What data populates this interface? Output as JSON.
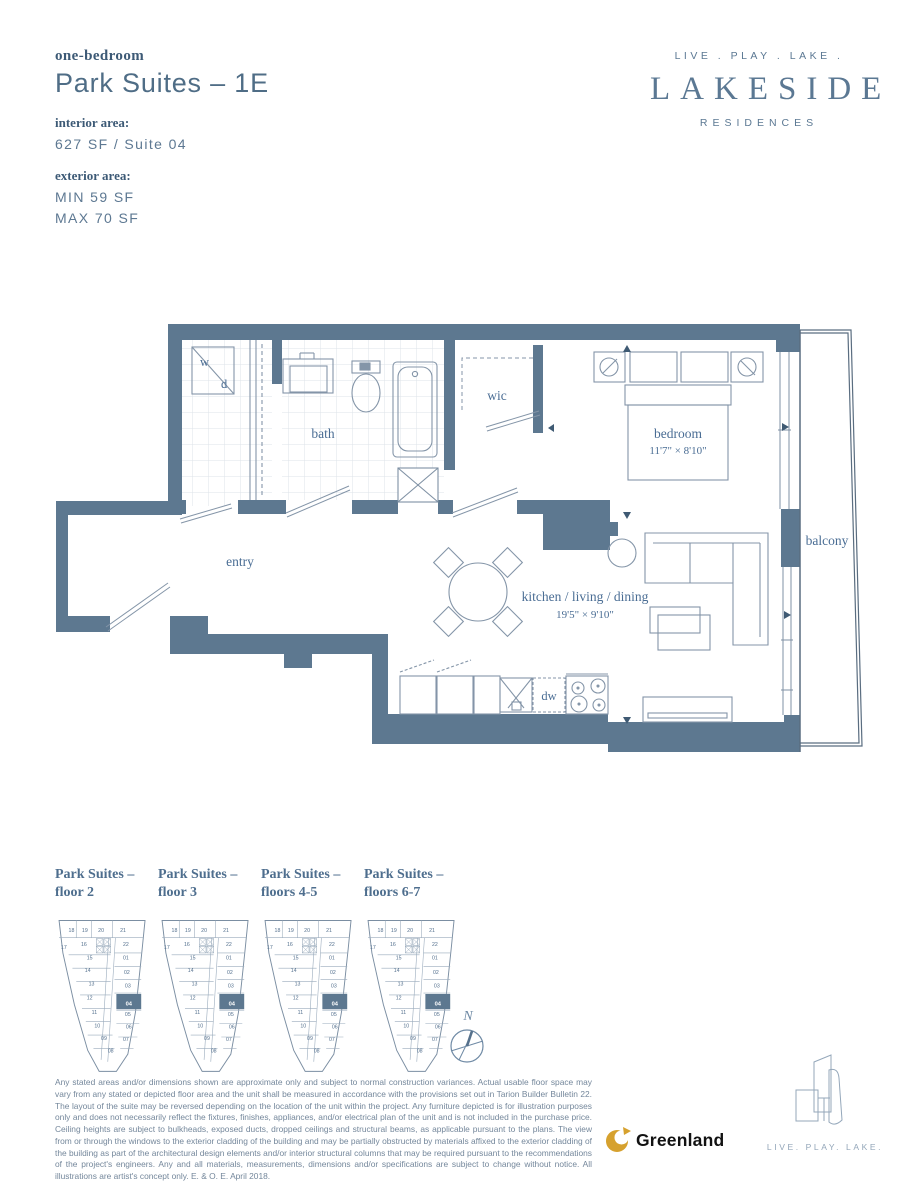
{
  "header": {
    "unit_type": "one-bedroom",
    "title": "Park Suites – 1E",
    "interior_label": "interior area:",
    "interior_value": "627 SF / Suite 04",
    "exterior_label": "exterior area:",
    "exterior_min": "MIN 59 SF",
    "exterior_max": "MAX 70 SF"
  },
  "brand": {
    "tagline": "LIVE . PLAY . LAKE .",
    "name": "LAKESIDE",
    "subname": "RESIDENCES"
  },
  "floorplan": {
    "labels": {
      "washer": "w",
      "dryer": "d",
      "bath": "bath",
      "wic": "wic",
      "bedroom": "bedroom",
      "bedroom_dims": "11'7\" × 8'10\"",
      "balcony": "balcony",
      "entry": "entry",
      "main_room": "kitchen / living / dining",
      "main_room_dims": "19'5\" × 9'10\"",
      "dishwasher": "dw"
    }
  },
  "keyplans": {
    "items": [
      {
        "label1": "Park Suites –",
        "label2": "floor 2"
      },
      {
        "label1": "Park Suites –",
        "label2": "floor 3"
      },
      {
        "label1": "Park Suites –",
        "label2": "floors 4-5"
      },
      {
        "label1": "Park Suites –",
        "label2": "floors 6-7"
      }
    ],
    "units": [
      "18",
      "19",
      "20",
      "21",
      "17",
      "16",
      "22",
      "15",
      "01",
      "14",
      "02",
      "13",
      "03",
      "12",
      "04",
      "11",
      "05",
      "10",
      "06",
      "09",
      "07",
      "08"
    ],
    "highlighted_unit": "04"
  },
  "compass": {
    "north_label": "N"
  },
  "footer": {
    "disclaimer": "Any stated areas and/or dimensions shown are approximate only and subject to normal construction variances. Actual usable floor space may vary from any stated or depicted floor area and the unit shall be measured in accordance with the provisions set out in Tarion Builder Bulletin 22. The layout of the suite may be reversed depending on the location of the unit within the project. Any furniture depicted is for illustration purposes only and does not necessarily reflect the fixtures, finishes, appliances, and/or electrical plan of the unit and is not included in the purchase price. Ceiling heights are subject to bulkheads, exposed ducts, dropped ceilings and structural beams, as applicable pursuant to the plans. The view from or through the windows to the exterior cladding of the building and may be partially obstructed by materials affixed to the exterior cladding of the building as part of the architectural design elements and/or interior structural columns that may be required pursuant to the recommendations of the project's engineers. Any and all materials, measurements, dimensions and/or specifications are subject to change without notice. All illustrations are artist's concept only. E. & O. E. April 2018.",
    "developer": "Greenland",
    "tagline": "LIVE. PLAY. LAKE."
  },
  "colors": {
    "wall": "#5d7890",
    "line": "#66798d",
    "furniture_line": "#8495a8",
    "label_text": "#4a6d94",
    "gold": "#d6a12e"
  }
}
